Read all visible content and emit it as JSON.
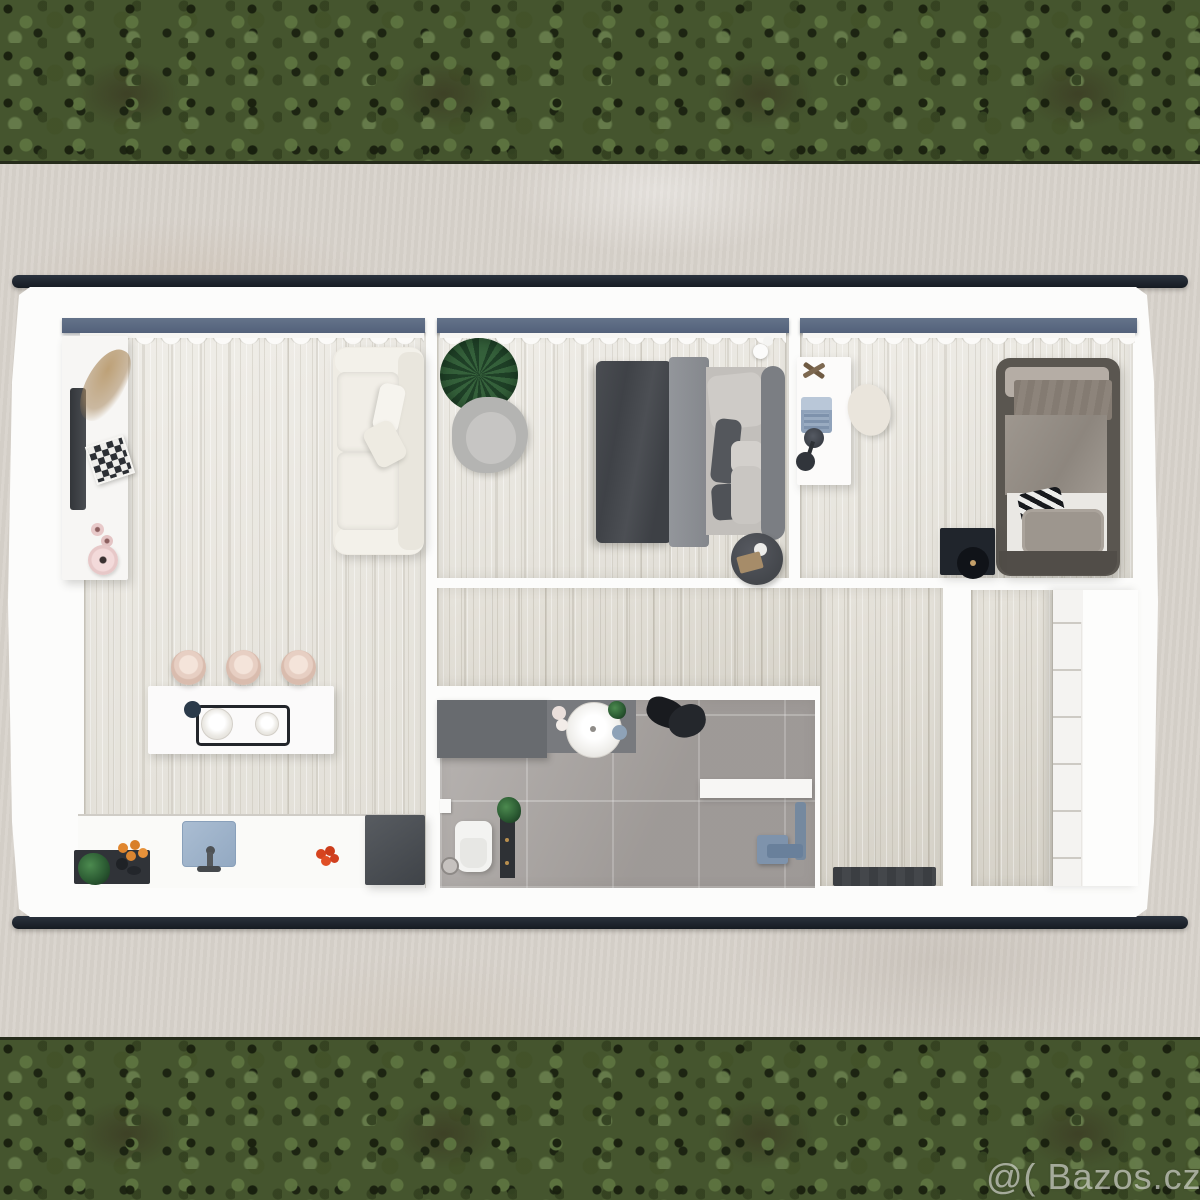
{
  "watermark": {
    "text": "@( Bazos.cz"
  },
  "scene": {
    "type": "top-down 3D floor plan render of a small rectangular house",
    "surroundings": {
      "top_band": "dark mottled green foliage",
      "bottom_band": "dark mottled green foliage",
      "ground": "light stained concrete pad"
    },
    "building": {
      "walls": "white",
      "roof_trim": "dark graphite bars along top and bottom facades",
      "window_rails": 3,
      "curtains": "white scalloped sheers along the top wall of all three front rooms"
    },
    "rooms": [
      {
        "id": "living-room-kitchen",
        "position": "left",
        "items": [
          "tv-sideboard",
          "tv",
          "dried-pampas-decor",
          "chessboard",
          "rose-discs",
          "sofa",
          "seat-cushions",
          "throw-pillows",
          "kitchen-island",
          "serving-tray",
          "bowls",
          "three-bar-stools",
          "kitchen-counter",
          "dark-shelf",
          "herb-plant",
          "oranges",
          "sink",
          "faucet",
          "tomatoes",
          "cooker-block"
        ]
      },
      {
        "id": "main-bedroom",
        "position": "top-middle",
        "items": [
          "potted-palm",
          "armchair",
          "double-bed",
          "charcoal-duvet",
          "folded-blanket",
          "pillows",
          "headboard",
          "round-side-table",
          "vase",
          "book",
          "ceiling-lamp"
        ]
      },
      {
        "id": "second-bedroom",
        "position": "top-right",
        "items": [
          "desk",
          "laptop",
          "dried-flower",
          "desk-lamp",
          "chair",
          "single-bed",
          "pillow-band",
          "patterned-runner",
          "taupe-duvet",
          "white-sheet",
          "accent-cushion",
          "gray-pillow",
          "record-player-box"
        ]
      },
      {
        "id": "hallway",
        "position": "middle-L-shape",
        "items": [
          "doormat",
          "coat-pile"
        ]
      },
      {
        "id": "bathroom",
        "position": "bottom-middle",
        "items": [
          "vanity-counter",
          "round-basin",
          "cosmetics",
          "mini-plant",
          "blue-dish",
          "toilet",
          "toilet-paper-holder",
          "floor-drain",
          "storage-column",
          "column-plant",
          "shower-bench",
          "shower-fixture"
        ]
      },
      {
        "id": "walk-in-closet",
        "position": "bottom-right",
        "items": [
          "wardrobe-shelves"
        ]
      }
    ]
  },
  "colors": {
    "foliage_green": "#45552e",
    "foliage_dark": "#232c18",
    "concrete": "#d8d3cc",
    "wall_white": "#fcfcfb",
    "roof_trim": "#1d232c",
    "window_rail": "#5c6b81",
    "wood_floor": "#e9e6de",
    "hall_wood": "#dfdbd1",
    "bathroom_tile": "#a8a3a0",
    "sofa_cream": "#efece4",
    "duvet_charcoal": "#45484d",
    "bed_taupe": "#979088",
    "stool_blush": "#e9d3c8",
    "sink_blue": "#9fb4cc",
    "shower_blue": "#7e93ac",
    "vanity_gray": "#686b6f",
    "watermark_white": "rgba(250,250,248,0.55)"
  }
}
